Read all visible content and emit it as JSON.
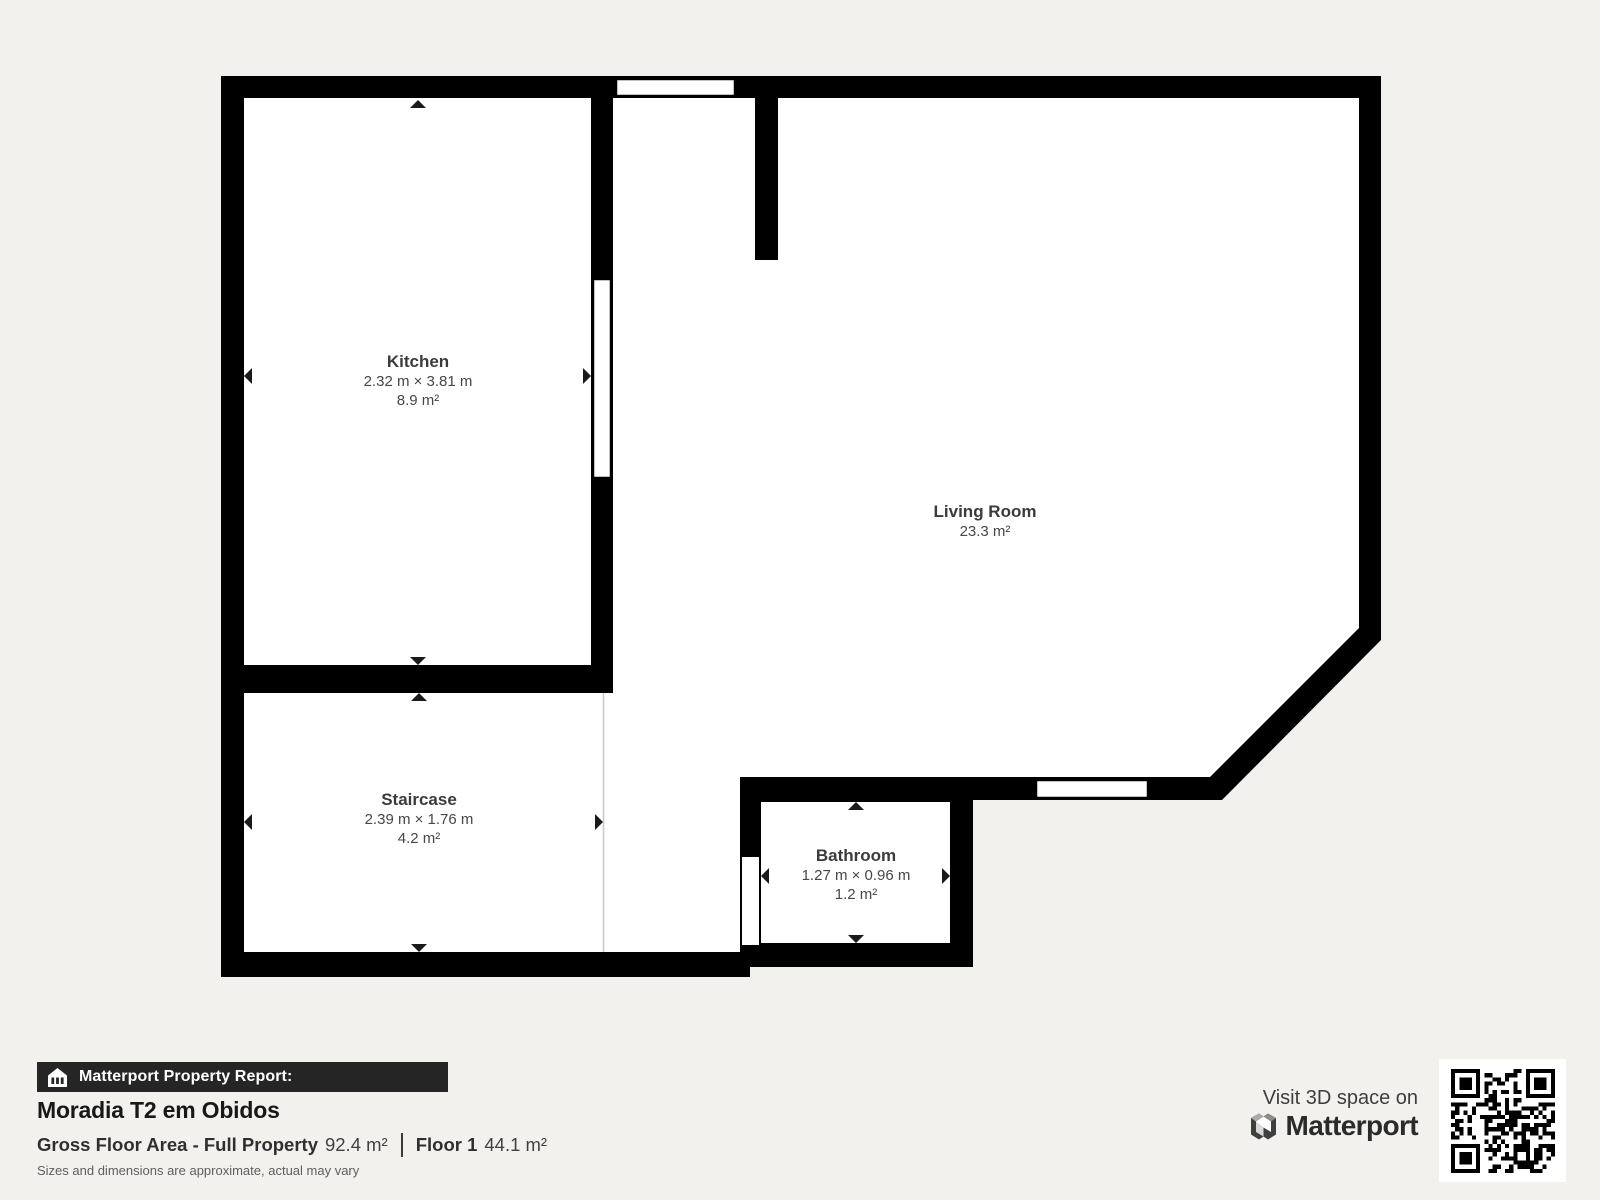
{
  "plan": {
    "rooms": [
      {
        "name": "Kitchen",
        "dimensions": "2.32 m × 3.81 m",
        "area": "8.9 m²"
      },
      {
        "name": "Living Room",
        "dimensions": "",
        "area": "23.3 m²"
      },
      {
        "name": "Staircase",
        "dimensions": "2.39 m × 1.76 m",
        "area": "4.2 m²"
      },
      {
        "name": "Bathroom",
        "dimensions": "1.27 m × 0.96 m",
        "area": "1.2 m²"
      }
    ]
  },
  "report": {
    "header": "Matterport Property Report:",
    "property_name": "Moradia T2 em Obidos",
    "gross_floor_area_label": "Gross Floor Area - Full Property",
    "gross_floor_area_value": "92.4 m²",
    "floor_label": "Floor 1",
    "floor_value": "44.1 m²",
    "disclaimer": "Sizes and dimensions are approximate, actual may vary"
  },
  "branding": {
    "visit_text": "Visit 3D space on",
    "brand_name": "Matterport"
  },
  "colors": {
    "background": "#f2f1ee",
    "wall": "#000000",
    "room_fill": "#ffffff",
    "label_text": "#3f3f3f",
    "report_bar_bg": "#252525",
    "report_bar_text": "#ffffff",
    "title_text": "#181818",
    "stats_text": "#2f2f2f",
    "disclaimer_text": "#5e5e5e",
    "brand_text": "#2b2b2b",
    "staircase_edge": "#c8c8c8"
  }
}
